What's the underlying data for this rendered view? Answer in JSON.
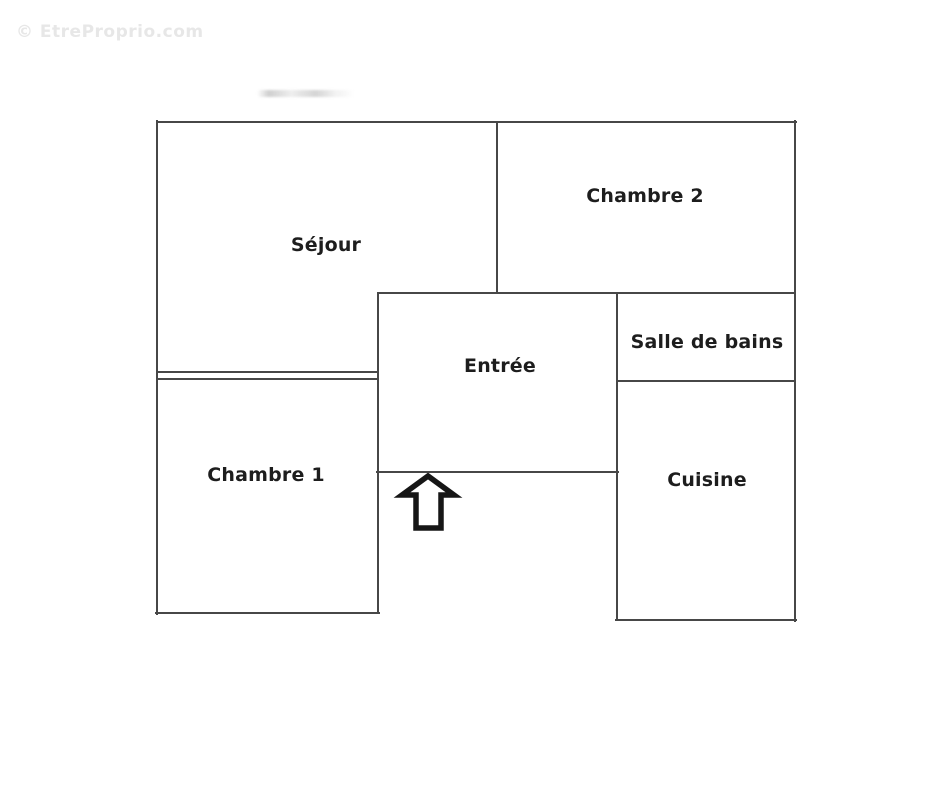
{
  "watermark": {
    "text": "© EtreProprio.com"
  },
  "colors": {
    "background": "#ffffff",
    "wall": "#474747",
    "label_text": "#1d1d1d",
    "watermark_text": "#e7e7e7",
    "arrow_stroke": "#161616"
  },
  "floorplan": {
    "rooms": {
      "sejour": {
        "label": "Séjour"
      },
      "chambre2": {
        "label": "Chambre 2"
      },
      "entree": {
        "label": "Entrée"
      },
      "salle_de_bains": {
        "label": "Salle de bains"
      },
      "chambre1": {
        "label": "Chambre 1"
      },
      "cuisine": {
        "label": "Cuisine"
      }
    },
    "entrance_arrow": {
      "icon": "up-arrow-icon"
    }
  }
}
